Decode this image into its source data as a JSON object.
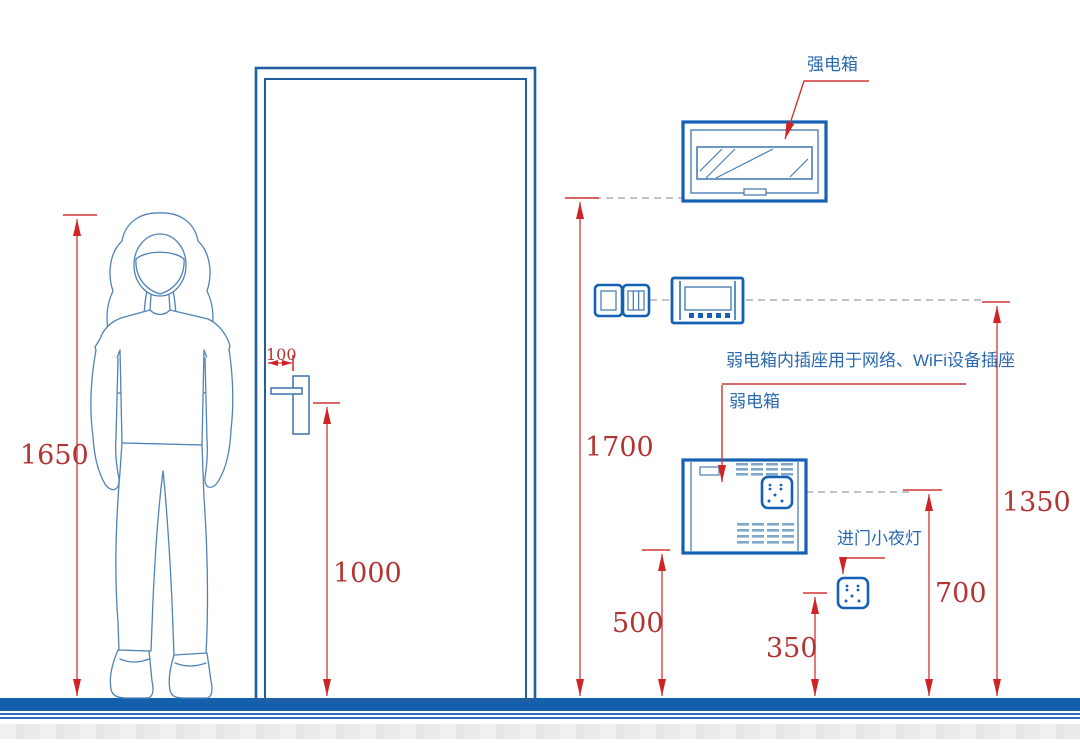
{
  "annotations": {
    "strong_box": "强电箱",
    "wifi_note": "弱电箱内插座用于网络、WiFi设备插座",
    "weak_box": "弱电箱",
    "night_light": "进门小夜灯"
  },
  "dimensions_mm": {
    "person_height": "1650",
    "handle_edge_offset": "100",
    "door_handle_height": "1000",
    "strong_box_height": "1700",
    "switch_panel_height": "1350",
    "weak_box_bottom_height": "500",
    "weak_box_socket_height": "700",
    "night_light_height": "350"
  },
  "colors": {
    "fixture_blue": "#1360b4",
    "outline_blue": "#5083b8",
    "door_blue": "#235e9e",
    "label_blue": "#2a68b0",
    "dimension_red": "#cf3535",
    "dimension_text_red": "#b33434",
    "floor_blue": "#1460ad",
    "dashed_gray": "#9aa0a4"
  }
}
